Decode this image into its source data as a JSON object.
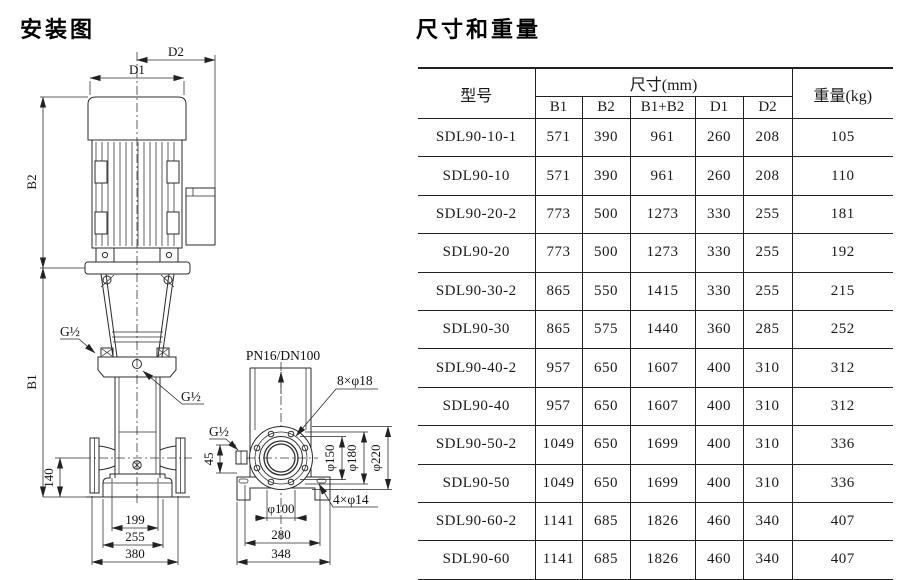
{
  "diagram": {
    "title": "安装图",
    "labels": {
      "d1": "D1",
      "d2": "D2",
      "b1": "B1",
      "b2": "B2",
      "g_half": "G½",
      "dim_140": "140",
      "dim_199": "199",
      "dim_255": "255",
      "dim_380": "380",
      "pn_rating": "PN16/DN100",
      "bolt_flange": "8×φ18",
      "dim_45": "45",
      "phi_150": "φ150",
      "phi_180": "φ180",
      "phi_220": "φ220",
      "phi_100": "φ100",
      "bolt_base": "4×φ14",
      "dim_280": "280",
      "dim_348": "348"
    }
  },
  "table": {
    "title": "尺寸和重量",
    "header": {
      "model": "型号",
      "size_group": "尺寸(mm)",
      "b1": "B1",
      "b2": "B2",
      "b1_plus_b2": "B1+B2",
      "d1": "D1",
      "d2": "D2",
      "weight": "重量(kg)"
    },
    "rows": [
      {
        "model": "SDL90-10-1",
        "b1": "571",
        "b2": "390",
        "b1b2": "961",
        "d1": "260",
        "d2": "208",
        "weight": "105"
      },
      {
        "model": "SDL90-10",
        "b1": "571",
        "b2": "390",
        "b1b2": "961",
        "d1": "260",
        "d2": "208",
        "weight": "110"
      },
      {
        "model": "SDL90-20-2",
        "b1": "773",
        "b2": "500",
        "b1b2": "1273",
        "d1": "330",
        "d2": "255",
        "weight": "181"
      },
      {
        "model": "SDL90-20",
        "b1": "773",
        "b2": "500",
        "b1b2": "1273",
        "d1": "330",
        "d2": "255",
        "weight": "192"
      },
      {
        "model": "SDL90-30-2",
        "b1": "865",
        "b2": "550",
        "b1b2": "1415",
        "d1": "330",
        "d2": "255",
        "weight": "215"
      },
      {
        "model": "SDL90-30",
        "b1": "865",
        "b2": "575",
        "b1b2": "1440",
        "d1": "360",
        "d2": "285",
        "weight": "252"
      },
      {
        "model": "SDL90-40-2",
        "b1": "957",
        "b2": "650",
        "b1b2": "1607",
        "d1": "400",
        "d2": "310",
        "weight": "312"
      },
      {
        "model": "SDL90-40",
        "b1": "957",
        "b2": "650",
        "b1b2": "1607",
        "d1": "400",
        "d2": "310",
        "weight": "312"
      },
      {
        "model": "SDL90-50-2",
        "b1": "1049",
        "b2": "650",
        "b1b2": "1699",
        "d1": "400",
        "d2": "310",
        "weight": "336"
      },
      {
        "model": "SDL90-50",
        "b1": "1049",
        "b2": "650",
        "b1b2": "1699",
        "d1": "400",
        "d2": "310",
        "weight": "336"
      },
      {
        "model": "SDL90-60-2",
        "b1": "1141",
        "b2": "685",
        "b1b2": "1826",
        "d1": "460",
        "d2": "340",
        "weight": "407"
      },
      {
        "model": "SDL90-60",
        "b1": "1141",
        "b2": "685",
        "b1b2": "1826",
        "d1": "460",
        "d2": "340",
        "weight": "407"
      }
    ]
  }
}
